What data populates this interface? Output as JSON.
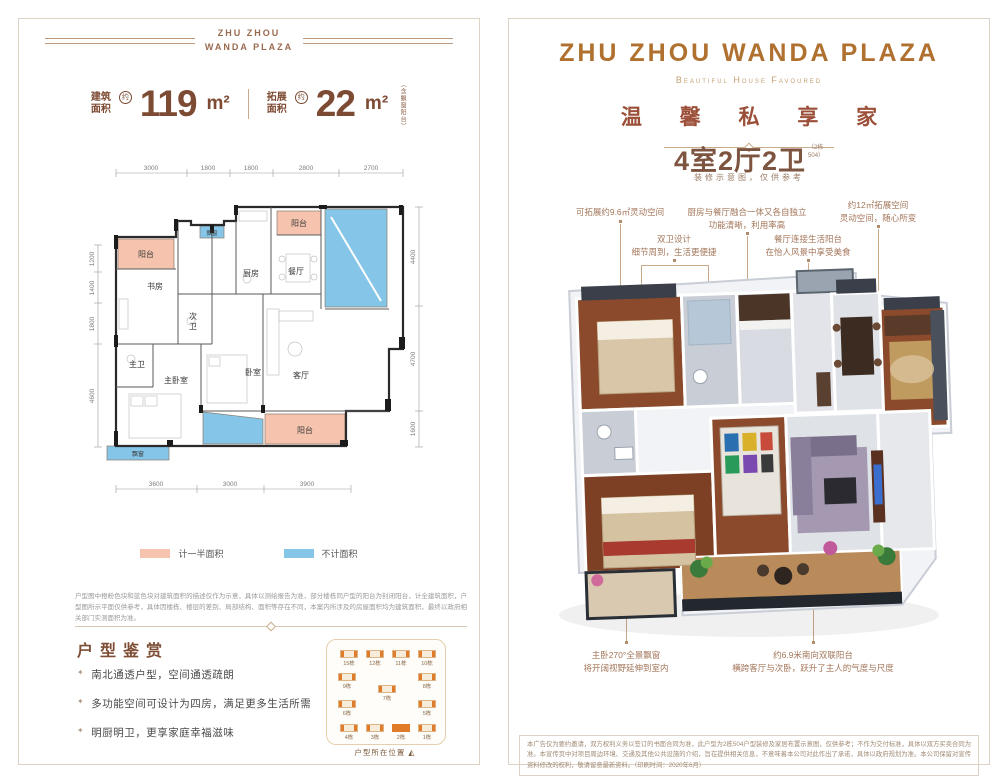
{
  "brand": {
    "logo_small": "ZHU ZHOU\nWANDA PLAZA",
    "title_en": "ZHU ZHOU WANDA PLAZA",
    "subtitle_en": "Beautiful House Favoured",
    "slogan_cn": "温 馨 私 享 家",
    "spec": "4室2厅2卫",
    "spec_note_l1": "2栋",
    "spec_note_l2": "504",
    "spec_caption": "装修示意图，仅供参考",
    "accent_color": "#b0702f",
    "slogan_color": "#9c4f38"
  },
  "left_panel": {
    "area": {
      "build_label": "建筑\n面积",
      "approx": "约",
      "build_value": "119",
      "unit": "m²",
      "expand_label": "拓展\n面积",
      "expand_value": "22",
      "expand_note": "（含飘窗阳台）"
    },
    "floorplan": {
      "dims_top": [
        "3000",
        "1800",
        "1800",
        "2800",
        "2700"
      ],
      "dims_left": [
        "1200",
        "1400",
        "1800",
        "4600"
      ],
      "dims_right": [
        "4400",
        "4700",
        "1600"
      ],
      "dims_bottom": [
        "3600",
        "3000",
        "3900"
      ],
      "rooms": {
        "balcony_tl": "阳台",
        "bay_top": "飘窗",
        "balcony_tr": "阳台",
        "study": "书房",
        "bath2_l1": "次",
        "bath2_l2": "卫",
        "kitchen": "厨房",
        "dining": "餐厅",
        "bath_m": "主卫",
        "bed_m": "主卧室",
        "bed2": "卧室",
        "living": "客厅",
        "balcony_b": "阳台",
        "bay_b": "飘窗"
      }
    },
    "legend": {
      "half_label": "计一半面积",
      "half_color": "#f6c4ae",
      "none_label": "不计面积",
      "none_color": "#85c6e8"
    },
    "disclaimer": "户型图中橙粉色块和蓝色块对建筑面积的描述仅作为示意，具体以测绘报告为准，部分楼栋同户型的阳台为封闭阳台，计全建筑面积，户型图所示平面仅供参考，具体因楼栋、楼层的差别、局部结构、面积等存在不同，本案内所涉及的房屋面积均为建筑面积，最终以政府相关部门实测面积为准。",
    "section_title": "户型鉴赏",
    "bullets": [
      "南北通透户型，空间通透疏朗",
      "多功能空间可设计为四房，满足更多生活所需",
      "明厨明卫，更享家庭幸福滋味"
    ],
    "sitemap": {
      "buildings": [
        "15栋",
        "12栋",
        "11栋",
        "10栋",
        "9栋",
        "8栋",
        "7栋",
        "6栋",
        "5栋",
        "4栋",
        "3栋",
        "2栋",
        "1栋"
      ],
      "caption": "户型所在位置"
    }
  },
  "right_panel": {
    "annotations": {
      "expand96": {
        "l1": "可拓展约9.6㎡灵动空间"
      },
      "twobath": {
        "l1": "双卫设计",
        "l2": "细节周到，生活更便捷"
      },
      "kitchen": {
        "l1": "厨房与餐厅融合一体又各自独立",
        "l2": "功能清晰，利用率高"
      },
      "dining": {
        "l1": "餐厅连接生活阳台",
        "l2": "在怡人风景中享受美食"
      },
      "expand12": {
        "l1": "约12㎡拓展空间",
        "l2": "灵动空间，随心所变"
      },
      "baywin": {
        "l1": "主卧270°全景飘窗",
        "l2": "将开阔视野延伸到室内"
      },
      "balcony": {
        "l1": "约6.9米南向双联阳台",
        "l2": "横跨客厅与次卧，跃升了主人的气度与尺度"
      }
    },
    "fine_print": "本广告仅为要约邀请，双方权利义务以签订的书面合同为准，此户型为2栋504户型装修及家居布置示意图，仅供参考；不作为交付标准，具体以双方买卖合同为准。本宣传页中对项目周边环境、交通及其他公共设施的介绍，旨在提供相关信息，不意味着本公司对此作出了承诺，具体以政府规划为准。本公司保留对宣传资料修改的权利，敬请留意最新资料。（印刷时间：2020年6月）"
  }
}
